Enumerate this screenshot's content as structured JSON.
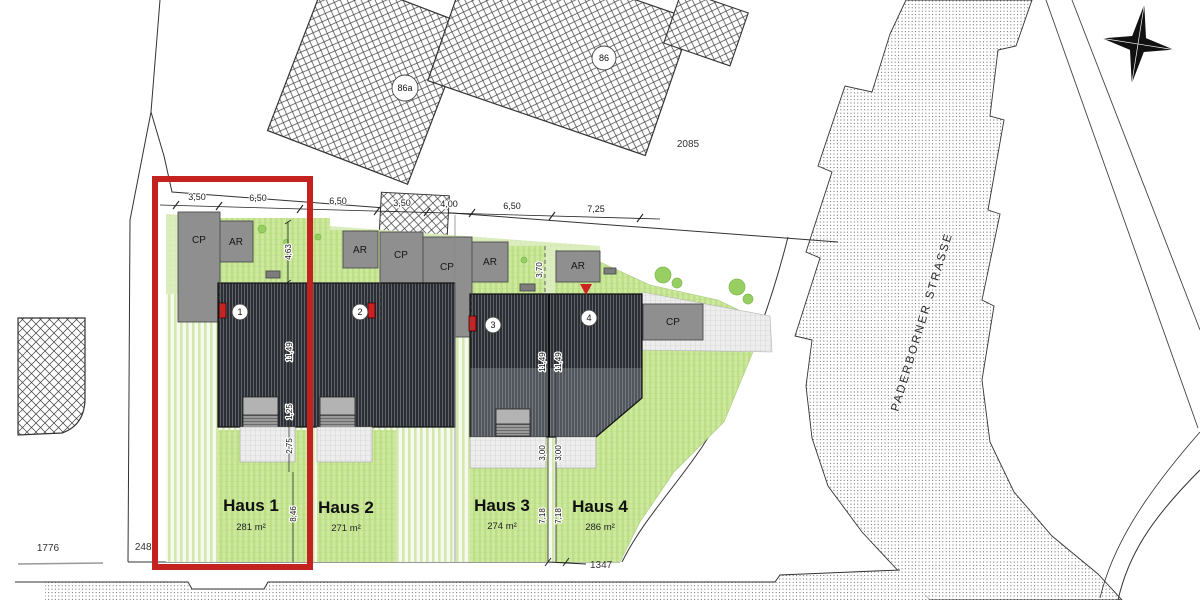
{
  "plan": {
    "street_name": "PADERBORNER STRASSE",
    "parcels": {
      "top": "2085",
      "left": "1776",
      "center": "2486",
      "bottom": "1347",
      "building_a": "86a",
      "building_b": "86"
    },
    "houses": [
      {
        "name": "Haus 1",
        "area": "281 m²",
        "no": "1"
      },
      {
        "name": "Haus 2",
        "area": "271 m²",
        "no": "2"
      },
      {
        "name": "Haus 3",
        "area": "274 m²",
        "no": "3"
      },
      {
        "name": "Haus 4",
        "area": "286 m²",
        "no": "4"
      }
    ],
    "zones": {
      "cp1": "CP",
      "ar1": "AR",
      "ar2": "AR",
      "cp2": "CP",
      "cp3": "CP",
      "ar3": "AR",
      "ar4": "AR",
      "cp4": "CP"
    },
    "dims_top": [
      "3,50",
      "6,50",
      "6,50",
      "3,50",
      "4,00",
      "6,50",
      "7,25"
    ],
    "dims_side": {
      "front1": "4,63",
      "front4": "3,70",
      "roof12": "11,49",
      "roof34_left": "11,49",
      "roof34_right": "11,49",
      "terrace1a": "1,25",
      "terrace1b": "2,75",
      "terrace3": "3,00",
      "terrace4": "3,00",
      "garden1": "8,46",
      "garden3": "7,18",
      "garden4": "7,18"
    },
    "colors": {
      "highlight_red": "#c4221f",
      "marker_red": "#cc2222",
      "roof_dark": "#2b2f35",
      "roof_light": "#51565d",
      "box_gray": "#8f8f8f",
      "lawn_pale": "#dcedbe",
      "lawn_bright": "#cde9a0"
    }
  }
}
